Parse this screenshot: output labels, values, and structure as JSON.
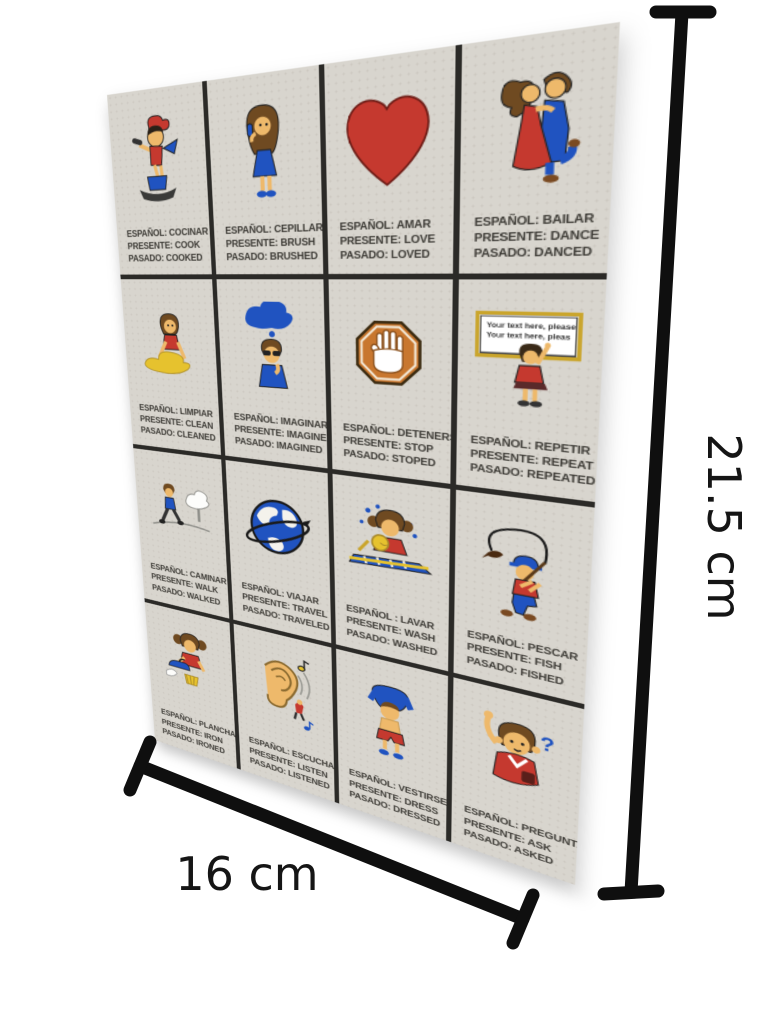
{
  "image_type": "product-photo of a Spanish verb flashcard with size annotations",
  "annotations": {
    "width_label": "16 cm",
    "height_label": "21.5 cm"
  },
  "card": {
    "rows": 4,
    "columns": 4,
    "cells": [
      {
        "icon": "cooking-icon",
        "es": "ESPAÑOL: COCINAR",
        "present": "PRESENTE: COOK",
        "past": "PASADO: COOKED"
      },
      {
        "icon": "hair-brushing-icon",
        "es": "ESPAÑOL: CEPILLAR",
        "present": "PRESENTE: BRUSH",
        "past": "PASADO: BRUSHED"
      },
      {
        "icon": "heart-icon",
        "es": "ESPAÑOL: AMAR",
        "present": "PRESENTE: LOVE",
        "past": "PASADO: LOVED"
      },
      {
        "icon": "dancing-couple-icon",
        "es": "ESPAÑOL: BAILAR",
        "present": "PRESENTE: DANCE",
        "past": "PASADO: DANCED"
      },
      {
        "icon": "cleaning-icon",
        "es": "ESPAÑOL: LIMPIAR",
        "present": "PRESENTE: CLEAN",
        "past": "PASADO: CLEANED"
      },
      {
        "icon": "imagining-icon",
        "es": "ESPAÑOL: IMAGINAR",
        "present": "PRESENTE: IMAGINE",
        "past": "PASADO: IMAGINED"
      },
      {
        "icon": "stop-hand-icon",
        "es": "ESPAÑOL: DETENERSE",
        "present": "PRESENTE: STOP",
        "past": "PASADO: STOPED"
      },
      {
        "icon": "whiteboard-icon",
        "es": "ESPAÑOL: REPETIR",
        "present": "PRESENTE: REPEAT",
        "past": "PASADO: REPEATED",
        "board_line1": "Your text here, please",
        "board_line2": "Your text here, pleas"
      },
      {
        "icon": "walking-icon",
        "es": "ESPAÑOL: CAMINAR",
        "present": "PRESENTE: WALK",
        "past": "PASADO: WALKED"
      },
      {
        "icon": "globe-icon",
        "es": "ESPAÑOL: VIAJAR",
        "present": "PRESENTE: TRAVEL",
        "past": "PASADO: TRAVELED"
      },
      {
        "icon": "dish-washing-icon",
        "es": "ESPAÑOL : LAVAR",
        "present": "PRESENTE: WASH",
        "past": "PASADO: WASHED"
      },
      {
        "icon": "fishing-icon",
        "es": "ESPAÑOL: PESCAR",
        "present": "PRESENTE: FISH",
        "past": "PASADO: FISHED"
      },
      {
        "icon": "ironing-icon",
        "es": "ESPAÑOL: PLANCHAR",
        "present": "PRESENTE: IRON",
        "past": "PASADO: IRONED"
      },
      {
        "icon": "ear-listening-icon",
        "es": "ESPAÑOL: ESCUCHAR",
        "present": "PRESENTE: LISTEN",
        "past": "PASADO: LISTENED"
      },
      {
        "icon": "dressing-icon",
        "es": "ESPAÑOL: VESTIRSE",
        "present": "PRESENTE: DRESS",
        "past": "PASADO: DRESSED"
      },
      {
        "icon": "asking-icon",
        "es": "ESPAÑOL: PREGUNTAR",
        "present": "PRESENTE: ASK",
        "past": "PASADO: ASKED",
        "mark": "?"
      }
    ]
  },
  "colors": {
    "background": "#ffffff",
    "card_bg": "#d8d5ce",
    "grid_line": "#2b2a27",
    "caption_text": "#3d3b36",
    "annotation": "#151515",
    "red": "#c5392f",
    "blue": "#2053c0",
    "yellow": "#e6c22e",
    "skin": "#eeb96b",
    "hair": "#6f4a21",
    "orange": "#c8772f"
  }
}
